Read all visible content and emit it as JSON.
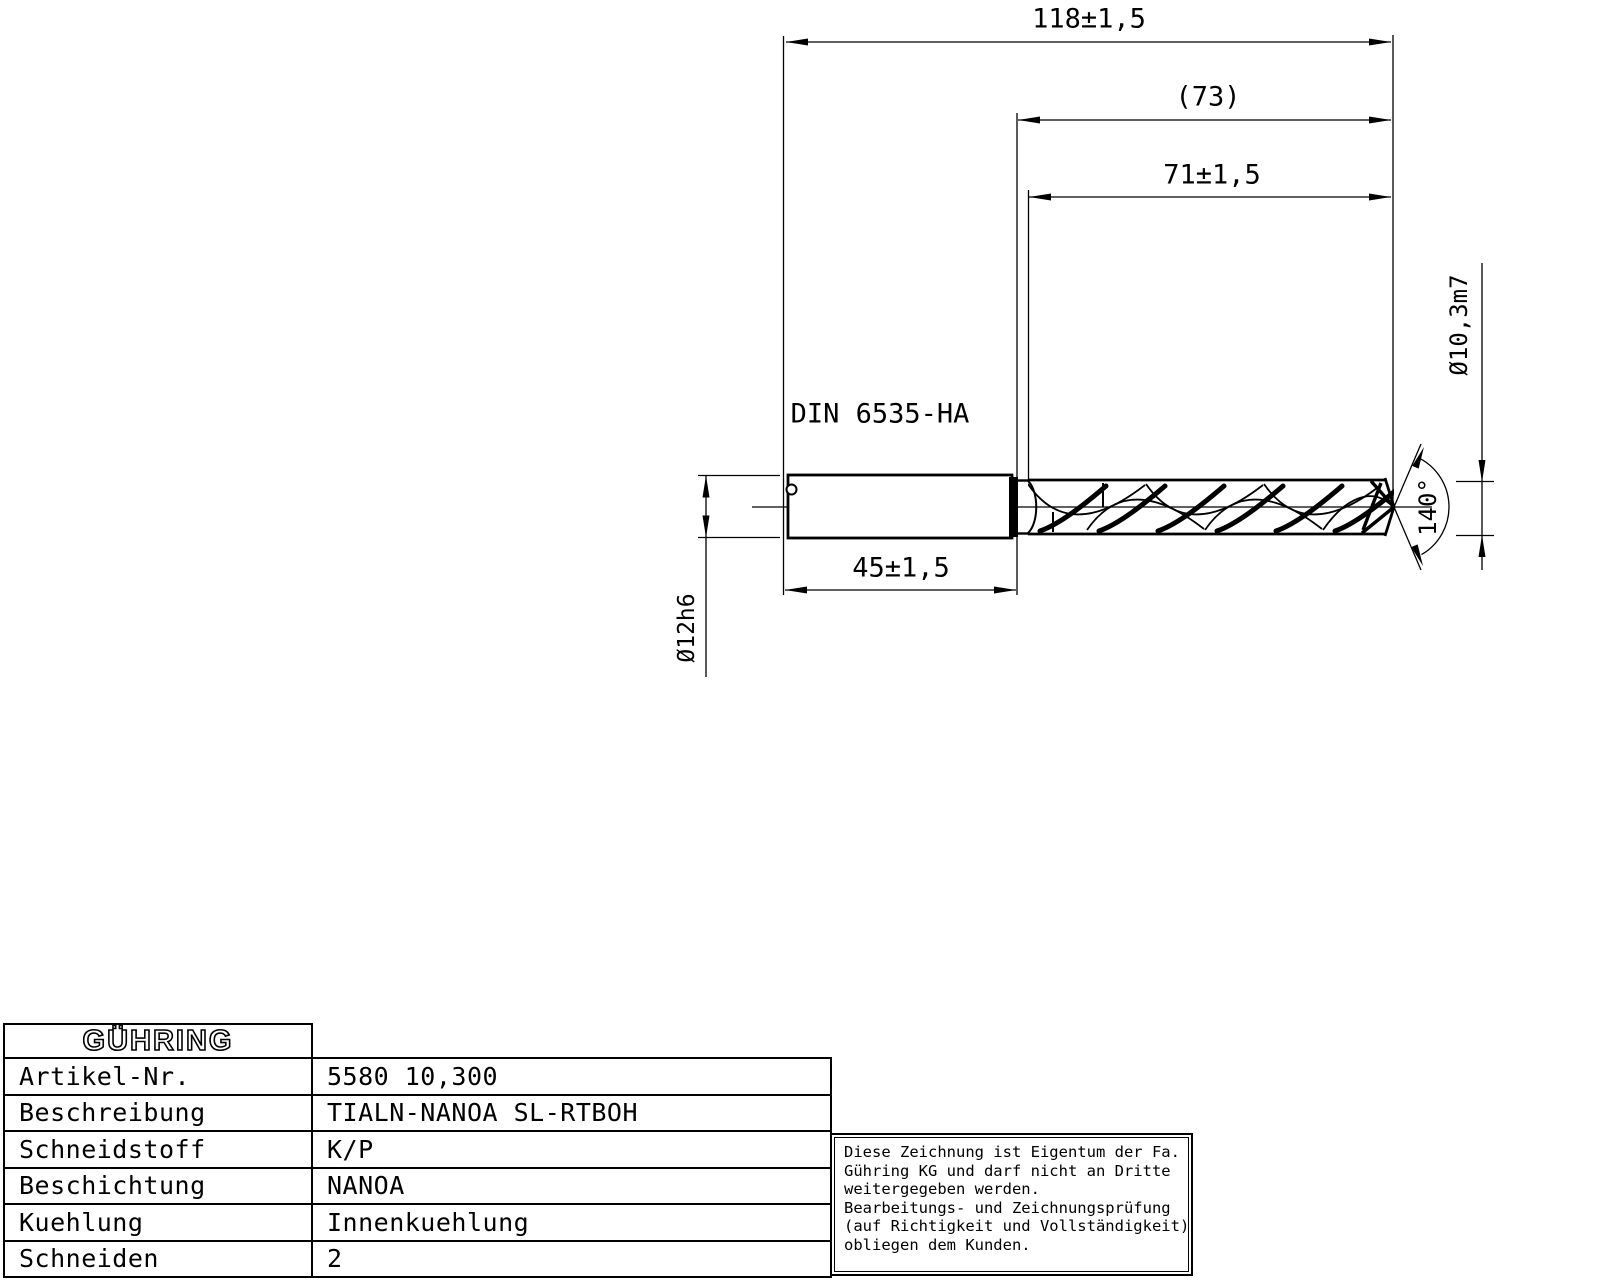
{
  "drawing": {
    "standard_label": "DIN 6535-HA",
    "dimensions": {
      "overall_length": "118±1,5",
      "flute_length_ref": "(73)",
      "flute_length": "71±1,5",
      "shank_length": "45±1,5",
      "shank_diameter": "Ø12h6",
      "cutting_diameter": "Ø10,3m7",
      "point_angle": "140°"
    }
  },
  "info_table": {
    "logo": "GÜHRING",
    "rows": [
      {
        "label": "Artikel-Nr.",
        "value": "5580 10,300"
      },
      {
        "label": "Beschreibung",
        "value": "TIALN-NANOA SL-RTBOH"
      },
      {
        "label": "Schneidstoff",
        "value": "K/P"
      },
      {
        "label": "Beschichtung",
        "value": "NANOA"
      },
      {
        "label": "Kuehlung",
        "value": "Innenkuehlung"
      },
      {
        "label": "Schneiden",
        "value": "2"
      }
    ]
  },
  "note_box": {
    "lines": [
      "Diese Zeichnung ist Eigentum der Fa.",
      "Gühring KG und darf nicht an Dritte",
      "weitergegeben werden.",
      "Bearbeitungs- und Zeichnungsprüfung",
      "(auf Richtigkeit und Vollständigkeit)",
      "obliegen dem Kunden."
    ]
  },
  "colors": {
    "line": "#000000",
    "background": "#ffffff"
  }
}
